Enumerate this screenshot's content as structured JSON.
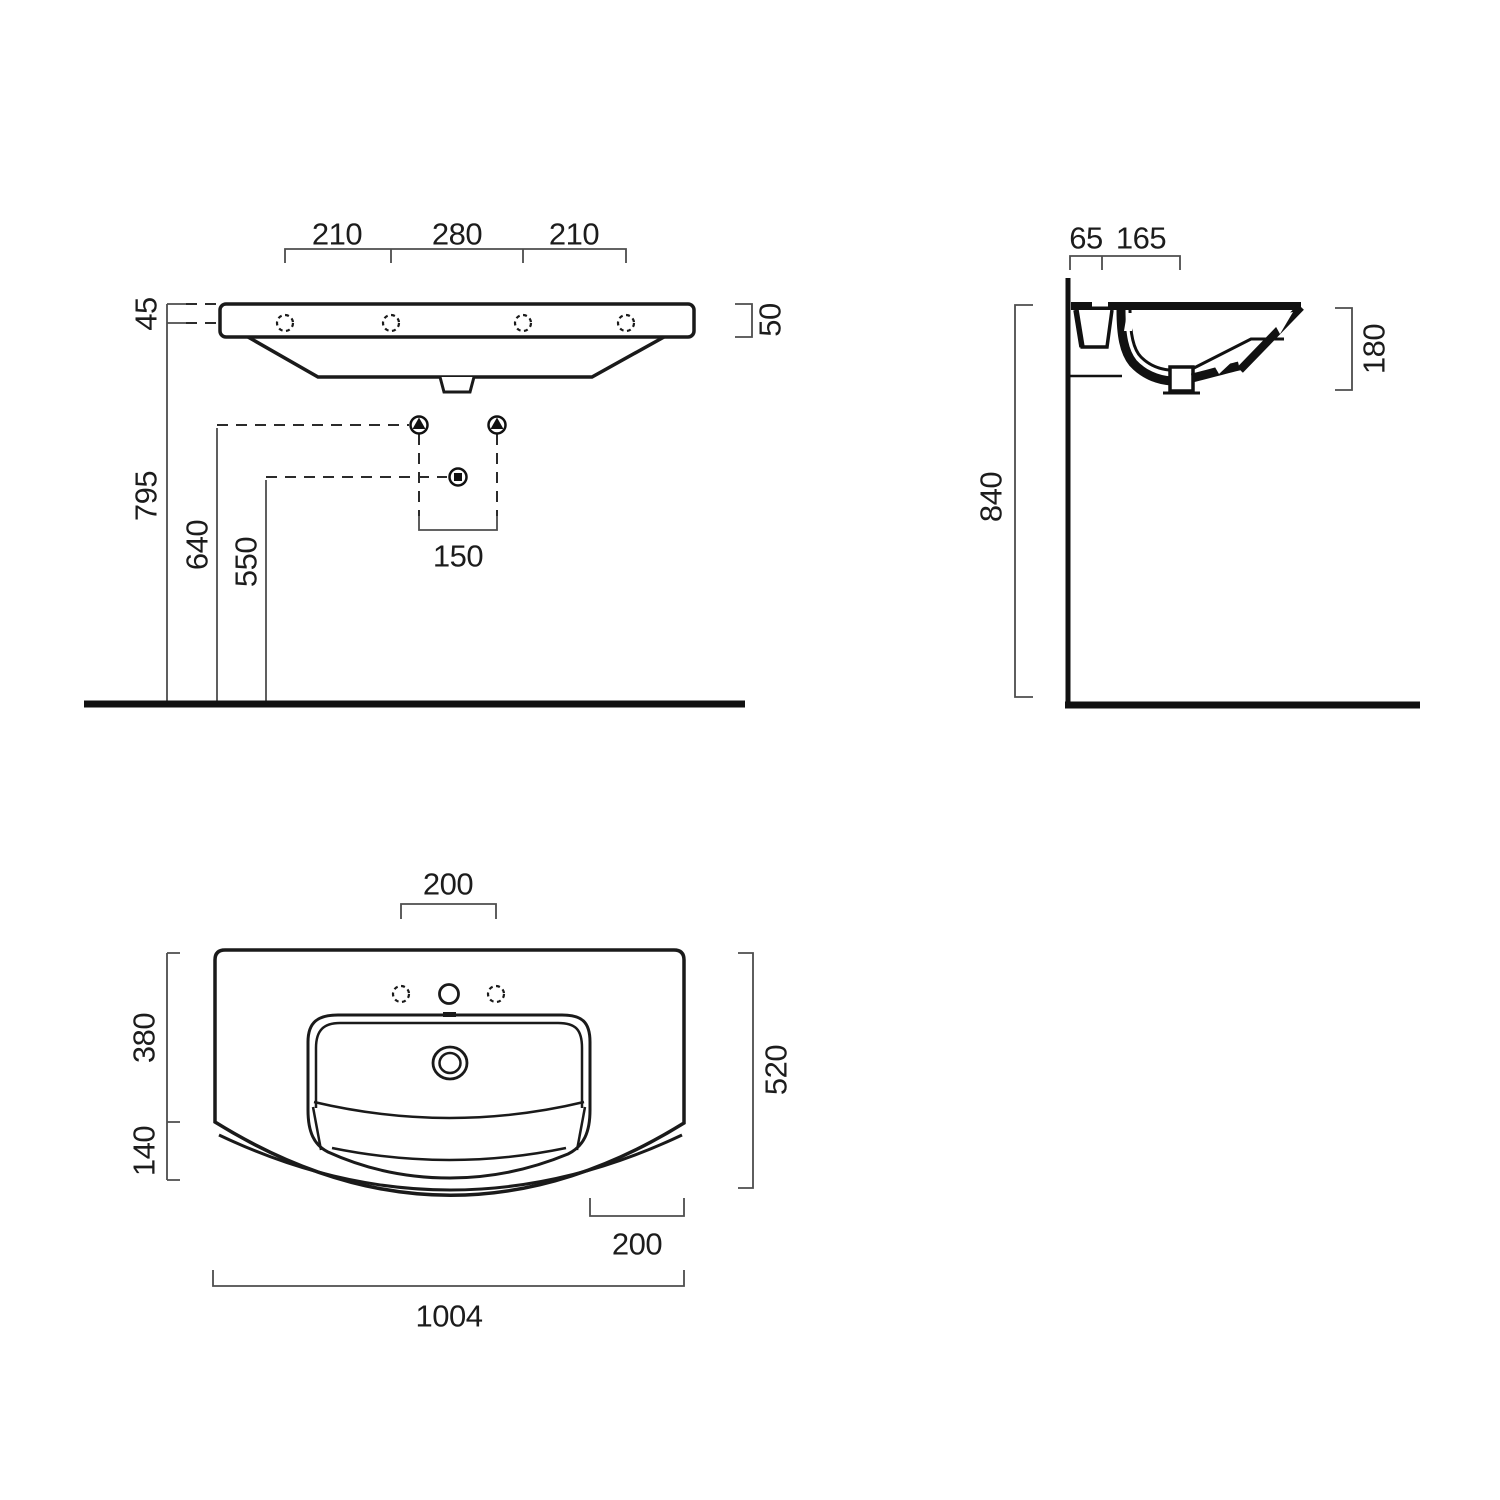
{
  "front": {
    "top_dims": [
      "210",
      "280",
      "210"
    ],
    "hole_offset": "45",
    "apron_height": "50",
    "holes_height": "795",
    "supply_height": "640",
    "drain_height": "550",
    "supply_spacing": "150"
  },
  "side": {
    "fixing_offset": "65",
    "hole_offset": "165",
    "depth": "180",
    "rim_height": "840"
  },
  "plan": {
    "hole_spacing": "200",
    "basin_depth": "380",
    "front_overhang": "140",
    "overall_depth": "520",
    "corner_flat": "200",
    "overall_width": "1004"
  },
  "colors": {
    "line": "#1a1a1a",
    "dim": "#4d4d4d",
    "background": "#ffffff"
  }
}
